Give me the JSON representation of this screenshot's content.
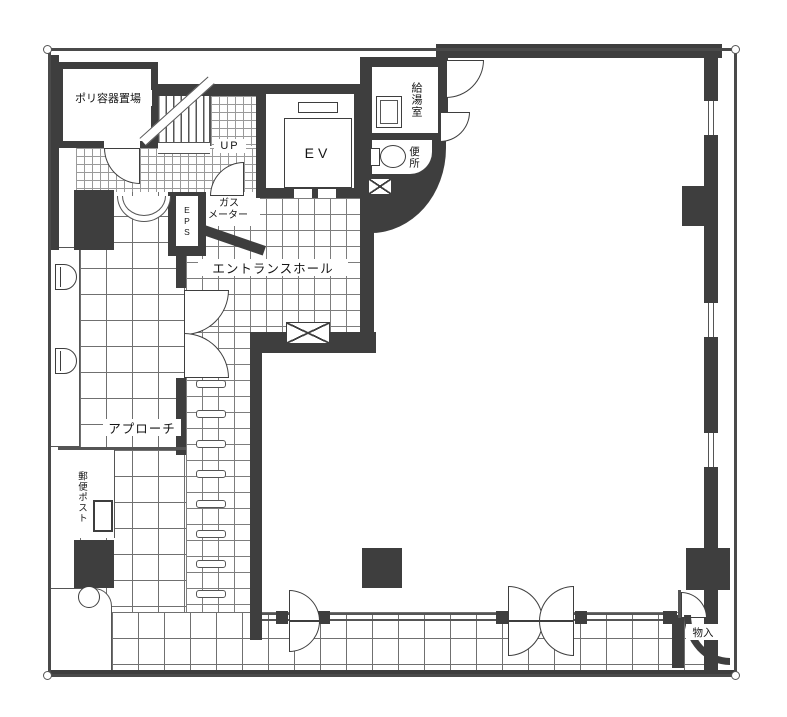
{
  "plan_title": "first-floor-plan",
  "labels": {
    "poly_storage": "ポリ容器置場",
    "up": "UP",
    "elevator": "EV",
    "kitchenette": "給湯室",
    "toilet": "便所",
    "eps": "EPS",
    "gas_line1": "ガス",
    "gas_line2": "メーター",
    "entrance_hall": "エントランスホール",
    "approach": "アプローチ",
    "mail_post": "郵便ポスト",
    "storage": "物入"
  },
  "colors": {
    "wall": "#3e3e3e",
    "line": "#555555",
    "paper": "#ffffff",
    "grid_fine": "#9a9a9a",
    "grid_medium": "#7d7d7d",
    "grid_coarse": "#707070"
  }
}
